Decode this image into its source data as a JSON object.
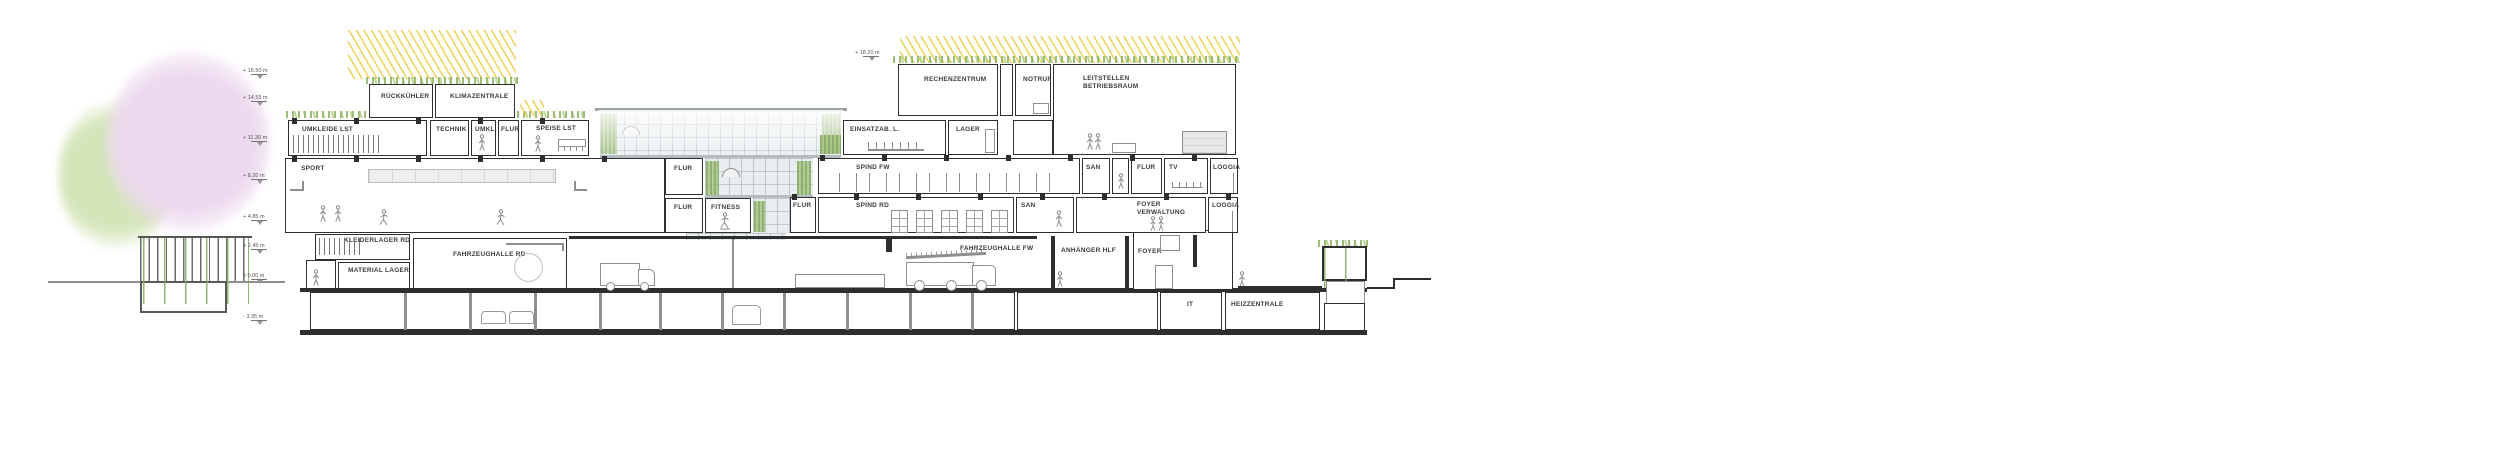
{
  "drawing": {
    "type": "architectural cross-section, fire & rescue station with control centre",
    "colors": {
      "wall": "#2e2e2e",
      "secondary_line": "#8f8f8f",
      "plant_green": "#93b86a",
      "green_wall": "#7fa75c",
      "sun_ray_yellow": "#edc93e",
      "tree_green": "#d4e5ba",
      "tree_pink": "#ecd9ee",
      "glass": "#d6dee2"
    }
  },
  "markers": {
    "left": [
      {
        "label": "+ 16.50 m"
      },
      {
        "label": "+ 14.55 m"
      },
      {
        "label": "+ 11.30 m"
      },
      {
        "label": "+ 8.20 m"
      },
      {
        "label": "+ 4.85 m"
      },
      {
        "label": "+ 2.45 m"
      },
      {
        "label": "± 0.00 m"
      },
      {
        "label": "- 3.35 m"
      }
    ],
    "right": {
      "label": "+ 18.20 m"
    }
  },
  "rooms": {
    "rueckkuehler": "RÜCKKÜHLER",
    "klimazentrale": "KLIMAZENTRALE",
    "umkleide_lst": "UMKLEIDE LST",
    "technik": "TECHNIK",
    "umkl": "UMKL.",
    "flur_og2": "FLUR",
    "speise_lst": "SPEISE LST",
    "sport": "SPORT",
    "flur_upper": "FLUR",
    "flur_lower": "FLUR",
    "fitness": "FITNESS",
    "kleiderlager_rd": "KLEIDERLAGER RD",
    "material_lager": "MATERIAL LAGER",
    "fahrzeughalle_rd": "FAHRZEUGHALLE RD",
    "fahrzeughalle_fw": "FAHRZEUGHALLE FW",
    "anhaenger_hlf": "ANHÄNGER HLF",
    "foyer": "FOYER",
    "rechenzentrum": "RECHENZENTRUM",
    "notruf": "NOTRUF",
    "leitstellen_1": "LEITSTELLEN",
    "leitstellen_2": "BETRIEBSRAUM",
    "einsatzab": "EINSATZAB. L.",
    "lager": "LAGER",
    "spind_fw": "SPIND FW",
    "san_fw": "SAN",
    "flur_fw": "FLUR",
    "tv": "TV",
    "loggia_fw": "LOGGIA",
    "flur_rd": "FLUR",
    "spind_rd": "SPIND RD",
    "san_rd": "SAN",
    "foyer_verw_1": "FOYER",
    "foyer_verw_2": "VERWALTUNG",
    "loggia_rd": "LOGGIA",
    "it": "IT",
    "heizzentrale": "HEIZZENTRALE"
  }
}
